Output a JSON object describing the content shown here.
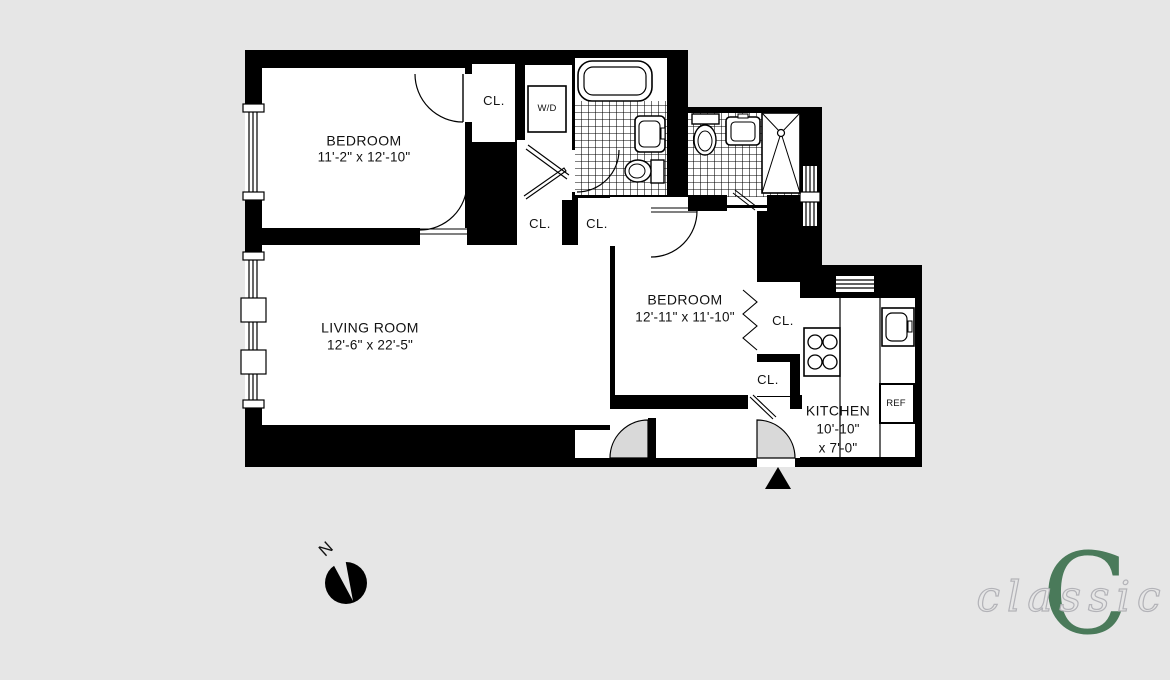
{
  "title": "Two bedroom apartment floor plan",
  "colors": {
    "background": "#e6e6e6",
    "walls": "#000000",
    "door_fill": "#d9d9d9",
    "logo_green": "#4a7a5a",
    "logo_script_gray": "#b3b3b8"
  },
  "rooms": {
    "bedroom1": {
      "name": "BEDROOM",
      "dims": "11'-2\" x 12'-10\""
    },
    "living": {
      "name": "LIVING ROOM",
      "dims": "12'-6\" x 22'-5\""
    },
    "bedroom2": {
      "name": "BEDROOM",
      "dims": "12'-11\" x 11'-10\""
    },
    "kitchen": {
      "name": "KITCHEN",
      "dims_line1": "10'-10\"",
      "dims_line2": "x 7'-0\""
    }
  },
  "labels": {
    "closet": "CL.",
    "washer_dryer": "W/D",
    "refrigerator": "REF"
  },
  "compass": {
    "north": "N"
  },
  "logo": {
    "monogram": "C",
    "script": "classic"
  }
}
